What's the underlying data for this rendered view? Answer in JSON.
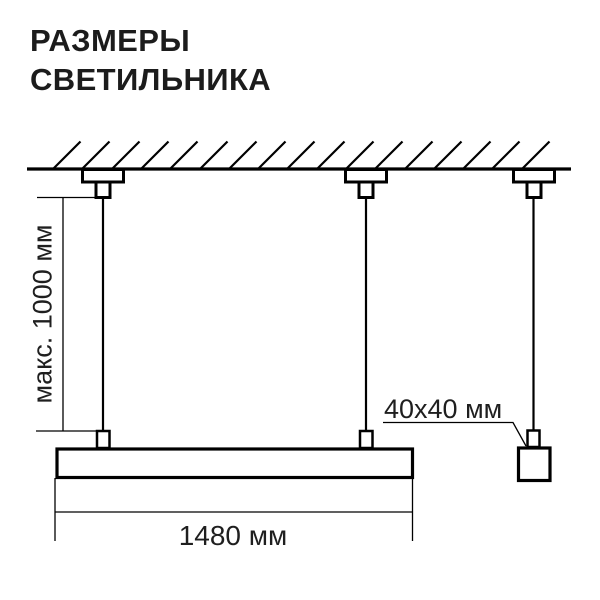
{
  "title": {
    "line1": "РАЗМЕРЫ",
    "line2": "СВЕТИЛЬНИКА"
  },
  "diagram": {
    "labels": {
      "max_height": "макс. 1000 мм",
      "length": "1480 мм",
      "profile": "40x40 мм"
    },
    "colors": {
      "line": "#000000",
      "text": "#1f1f1f",
      "background": "#ffffff"
    }
  }
}
